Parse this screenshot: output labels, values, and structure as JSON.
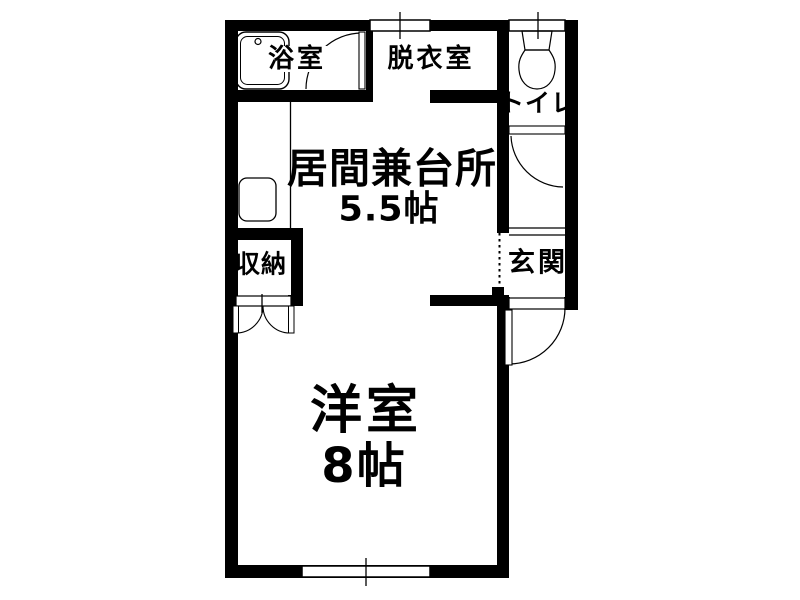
{
  "title": "apartment-floor-plan",
  "colors": {
    "wall": "#000000",
    "floor": "#ffffff",
    "text": "#000000"
  },
  "rooms": {
    "bathroom": {
      "label": "浴室"
    },
    "dressing_room": {
      "label": "脱衣室"
    },
    "toilet": {
      "label": "トイレ"
    },
    "living_kitchen": {
      "label": "居間兼台所",
      "size": "5.5帖"
    },
    "entrance": {
      "label": "玄関"
    },
    "storage": {
      "label": "収納"
    },
    "western_room": {
      "label": "洋室",
      "size": "8帖"
    }
  }
}
